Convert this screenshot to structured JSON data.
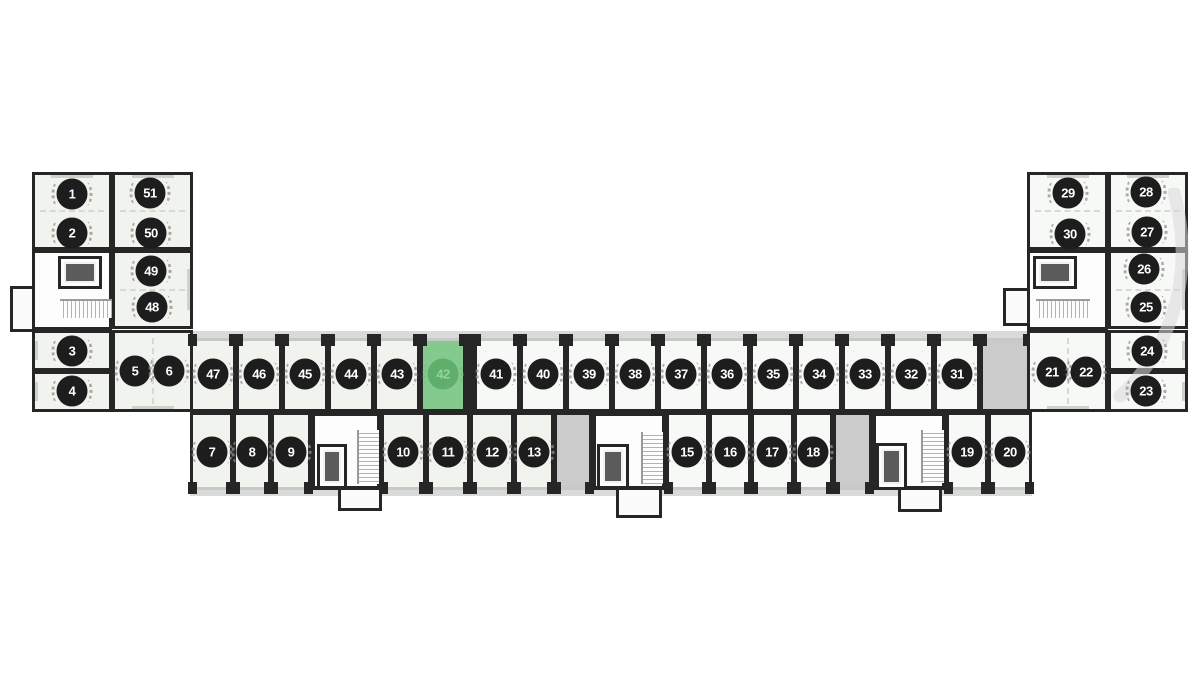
{
  "plan": {
    "selected_unit": "42",
    "units": [
      {
        "number": "1",
        "status": "available"
      },
      {
        "number": "2",
        "status": "available"
      },
      {
        "number": "3",
        "status": "available"
      },
      {
        "number": "4",
        "status": "available"
      },
      {
        "number": "5",
        "status": "available"
      },
      {
        "number": "6",
        "status": "available"
      },
      {
        "number": "7",
        "status": "available"
      },
      {
        "number": "8",
        "status": "available"
      },
      {
        "number": "9",
        "status": "available"
      },
      {
        "number": "10",
        "status": "available"
      },
      {
        "number": "11",
        "status": "available"
      },
      {
        "number": "12",
        "status": "available"
      },
      {
        "number": "13",
        "status": "available"
      },
      {
        "number": "15",
        "status": "available"
      },
      {
        "number": "16",
        "status": "available"
      },
      {
        "number": "17",
        "status": "available"
      },
      {
        "number": "18",
        "status": "available"
      },
      {
        "number": "19",
        "status": "available"
      },
      {
        "number": "20",
        "status": "available"
      },
      {
        "number": "21",
        "status": "available"
      },
      {
        "number": "22",
        "status": "available"
      },
      {
        "number": "23",
        "status": "available"
      },
      {
        "number": "24",
        "status": "available"
      },
      {
        "number": "25",
        "status": "available"
      },
      {
        "number": "26",
        "status": "available"
      },
      {
        "number": "27",
        "status": "available"
      },
      {
        "number": "28",
        "status": "available"
      },
      {
        "number": "29",
        "status": "available"
      },
      {
        "number": "30",
        "status": "available"
      },
      {
        "number": "31",
        "status": "available"
      },
      {
        "number": "32",
        "status": "available"
      },
      {
        "number": "33",
        "status": "available"
      },
      {
        "number": "34",
        "status": "available"
      },
      {
        "number": "35",
        "status": "available"
      },
      {
        "number": "36",
        "status": "available"
      },
      {
        "number": "37",
        "status": "available"
      },
      {
        "number": "38",
        "status": "available"
      },
      {
        "number": "39",
        "status": "available"
      },
      {
        "number": "40",
        "status": "available"
      },
      {
        "number": "41",
        "status": "available"
      },
      {
        "number": "42",
        "status": "selected"
      },
      {
        "number": "43",
        "status": "available"
      },
      {
        "number": "44",
        "status": "available"
      },
      {
        "number": "45",
        "status": "available"
      },
      {
        "number": "46",
        "status": "available"
      },
      {
        "number": "47",
        "status": "available"
      },
      {
        "number": "48",
        "status": "available"
      },
      {
        "number": "49",
        "status": "available"
      },
      {
        "number": "50",
        "status": "available"
      },
      {
        "number": "51",
        "status": "available"
      }
    ]
  },
  "colors": {
    "wall": "#262626",
    "badge": "#1d1d1d",
    "badge_text": "#ffffff",
    "selected_room": "#84ca8f",
    "selected_badge": "#5fae6c",
    "selected_badge_text": "#94d49e",
    "unavailable_room": "#cbcbcb",
    "room_light": "#f1f4ee",
    "room_white": "#f7f9f6",
    "corridor": "#fdfdfd",
    "glass": "#c6cac4",
    "balcony": "#dadada"
  }
}
